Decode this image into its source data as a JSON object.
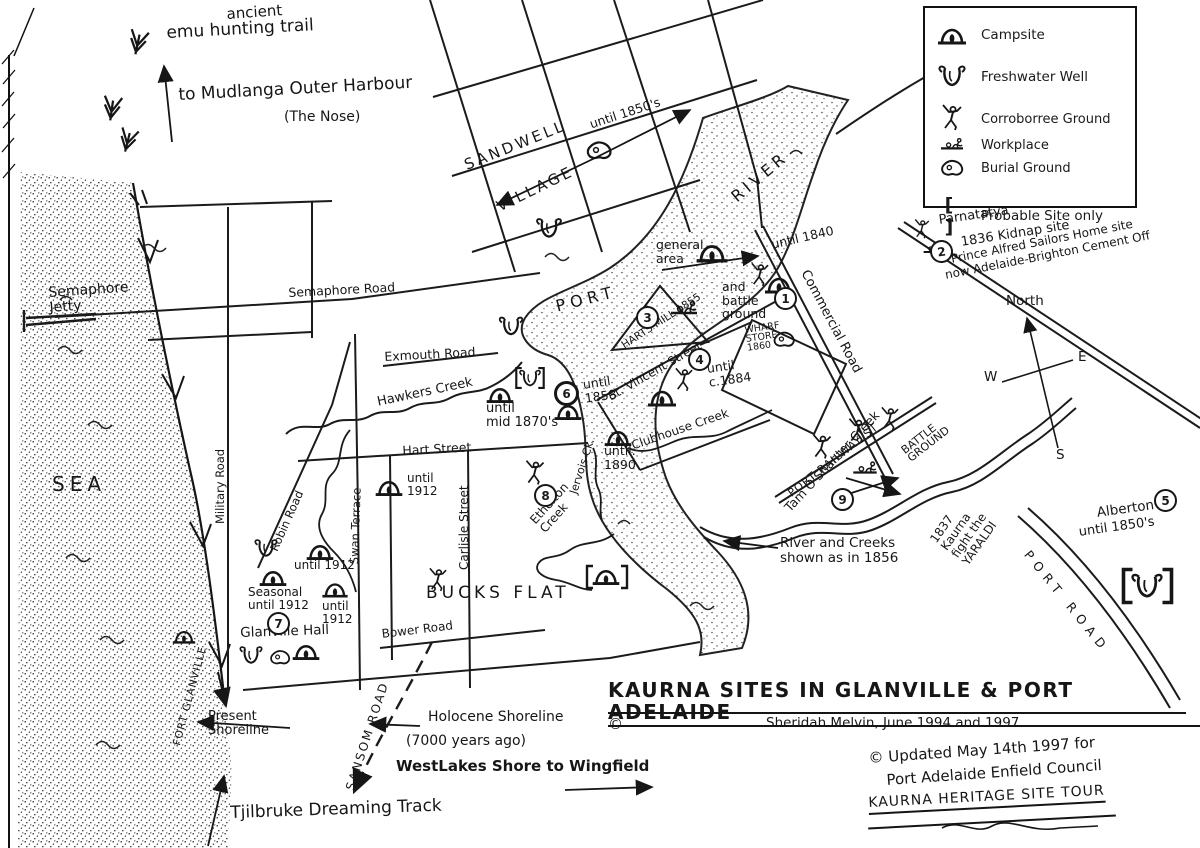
{
  "legend": {
    "items": [
      {
        "icon": "campsite-icon",
        "label": "Campsite"
      },
      {
        "icon": "freshwater-well-icon",
        "label": "Freshwater Well"
      },
      {
        "icon": "corroboree-ground-icon",
        "label": "Corroborree Ground"
      },
      {
        "icon": "workplace-icon",
        "label": "Workplace"
      },
      {
        "icon": "burial-ground-icon",
        "label": "Burial Ground"
      },
      {
        "icon": "probable-site-icon",
        "bracket": "[ ]",
        "label": "Probable Site only"
      }
    ]
  },
  "trails": {
    "ancient": "ancient",
    "emu": "emu hunting trail",
    "mudlanga": "to Mudlanga Outer Harbour",
    "nose": "(The Nose)",
    "tjilbruke": "Tjilbruke Dreaming Track"
  },
  "compass": {
    "north": "North",
    "east": "E",
    "west": "W",
    "south": "S"
  },
  "water": {
    "sea": "SEA",
    "port": "PORT",
    "river": "RIVER",
    "hawkers_creek": "Hawkers Creek",
    "ethelton_creek": "Ethelton\nCreek",
    "jervois_creek": "Jervois Ck.",
    "clubhouse_creek": "Clubhouse Creek",
    "tam_oshanter_creek": "Tam O'Shanter Creek",
    "river_note": "River and Creeks\nshown as in 1856"
  },
  "roads": {
    "semaphore_road": "Semaphore Road",
    "semaphore_jetty": "Semaphore\nJetty",
    "military_road": "Military Road",
    "robin_road": "Robin Road",
    "swan_terrace": "Swan Terrace",
    "exmouth_road": "Exmouth Road",
    "hart_street": "Hart Street",
    "carlisle_street": "Carlisle Street",
    "bower_road": "Bower Road",
    "sansom_road": "SANSOM ROAD",
    "commercial_road": "Commercial Road",
    "st_vincent_street": "St. Vincent Street",
    "port_railway_st": "PORT RAILWAY ST",
    "port_road": "PORT ROAD",
    "fort_glanville": "FORT GLANVILLE"
  },
  "places": {
    "sandwell": "SANDWELL",
    "village": "VILLAGE",
    "bucks_flat": "BUCKS FLAT",
    "glanville_hall": "Glanville Hall",
    "alberton": "Alberton",
    "alberton_until": "until 1850's"
  },
  "sites": {
    "numbers": {
      "n1": "1",
      "n2": "2",
      "n3": "3",
      "n4": "4",
      "n5": "5",
      "n6": "6",
      "n7": "7",
      "n8": "8",
      "n9": "9"
    },
    "general_area": "general\narea",
    "until_1840": "until 1840",
    "battle_ground_1": "and\nbattle\nground",
    "parnatatya": "Parnatatya",
    "kidnap": "1836 Kidnap site",
    "prince_alfred": "Prince Alfred Sailors Home site",
    "cement": "now Adelaide-Brighton Cement Off",
    "harts_mill": "HARTS MILL 1855",
    "wharf_store": "WHARF\nSTORE\n1860",
    "until_c1884": "until\nc.1884",
    "until_1858": "until\n1858",
    "until_mid_1870s": "until\nmid 1870's",
    "until_1890": "until.\n1890",
    "until_1912_a": "until\n1912",
    "until_1912_b": "until 1912",
    "seasonal_until_1912": "Seasonal\nuntil 1912",
    "until_1912_c": "until\n1912",
    "until_1850s_sandwell": "until 1850's",
    "battle_ground_9": "BATTLE\nGROUND",
    "kaurna_fight": "1837\nKaurna\nfight the\nYARALDI"
  },
  "notes": {
    "present_shoreline": "Present\nShoreline",
    "holocene_1": "Holocene Shoreline",
    "holocene_2": "(7000 years ago)",
    "westlakes": "WestLakes Shore to ",
    "wingfield": "Wingfield"
  },
  "title_block": {
    "title": "KAURNA SITES IN GLANVILLE & PORT ADELAIDE",
    "copyright": "©",
    "credit": "Sheridah Melvin, June 1994 and 1997"
  },
  "update_note": {
    "line1": "© Updated May 14th 1997 for",
    "line2": "Port Adelaide Enfield Council",
    "line3": "KAURNA HERITAGE SITE TOUR"
  },
  "colors": {
    "ink": "#1c1c1c",
    "paper": "#ffffff"
  }
}
